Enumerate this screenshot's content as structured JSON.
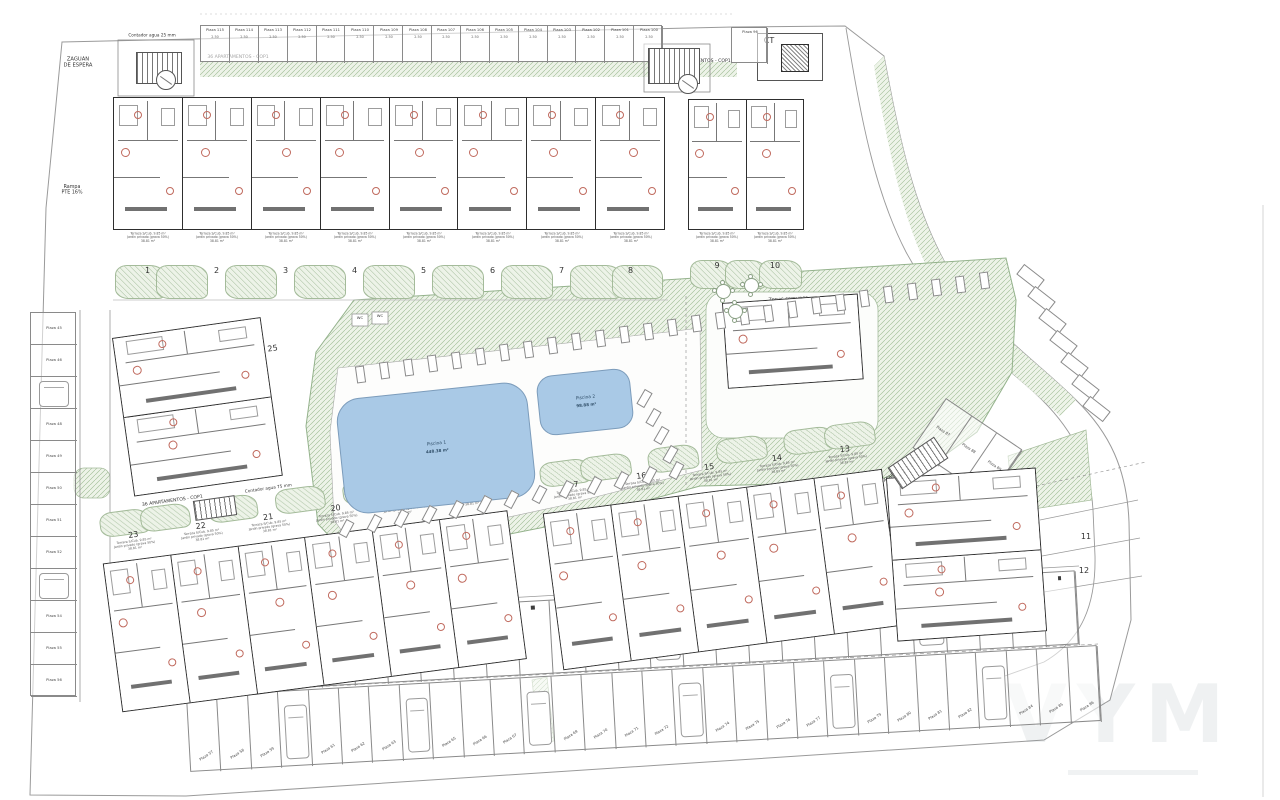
{
  "watermark": {
    "text": "VYM"
  },
  "shared": {
    "unit_caption": [
      "Terraza S/Cub. 9.85 m²",
      "Jardín privado (grava 50%)",
      "38.81 m²"
    ],
    "stall_dim": "2.50"
  },
  "annotations": [
    {
      "text": "ZAGUÁN\nDE ESPERA",
      "x": 78,
      "y": 56,
      "fs": 5.2
    },
    {
      "text": "Contador agua 25 mm",
      "x": 152,
      "y": 33,
      "fs": 4.2
    },
    {
      "text": "36 APARTAMENTOS - COP1",
      "x": 238,
      "y": 54,
      "fs": 4.6
    },
    {
      "text": "36 APARTAMENTOS - COP1",
      "x": 700,
      "y": 58,
      "fs": 4.6
    },
    {
      "text": "20.79 m²",
      "x": 808,
      "y": 34,
      "fs": 3.8
    },
    {
      "text": "Rampa\nPTE 16%",
      "x": 72,
      "y": 184,
      "fs": 4.8
    },
    {
      "text": "36 APARTAMENTOS - COP1",
      "x": 172,
      "y": 498,
      "fs": 4.6,
      "rot": -8
    },
    {
      "text": "Contador agua 75 mm",
      "x": 268,
      "y": 486,
      "fs": 4.2,
      "rot": -8
    },
    {
      "text": "Zonas comunes",
      "x": 788,
      "y": 296,
      "fs": 5,
      "rot": -3
    },
    {
      "text": "40 APARTAMENTOS - COP2",
      "x": 902,
      "y": 466,
      "fs": 4.6,
      "rot": -33
    },
    {
      "text": "WC",
      "x": 360,
      "y": 316,
      "fs": 3.8
    },
    {
      "text": "WC",
      "x": 380,
      "y": 314,
      "fs": 3.8
    },
    {
      "text": "25",
      "x": 272,
      "y": 344,
      "fs": 8,
      "rot": -8
    },
    {
      "text": "24",
      "x": 264,
      "y": 452,
      "fs": 8,
      "rot": -8
    },
    {
      "text": "11",
      "x": 1086,
      "y": 532,
      "fs": 8
    },
    {
      "text": "12",
      "x": 1084,
      "y": 566,
      "fs": 8
    }
  ],
  "ct": {
    "label": "CT",
    "x": 757,
    "y": 33,
    "w": 64,
    "h": 46,
    "inner": {
      "x": 781,
      "y": 44,
      "w": 26,
      "h": 26
    }
  },
  "parking": [
    {
      "name": "top-row",
      "x": 200,
      "y": 25,
      "w": 462,
      "h": 37,
      "count": 16,
      "label_pos": "top",
      "dim": true,
      "labels": [
        "Plaza 115",
        "Plaza 114",
        "Plaza 113",
        "Plaza 112",
        "Plaza 111",
        "Plaza 110",
        "Plaza 109",
        "Plaza 108",
        "Plaza 107",
        "Plaza 106",
        "Plaza 105",
        "Plaza 104",
        "Plaza 103",
        "Plaza 102",
        "Plaza 101",
        "Plaza 100"
      ]
    },
    {
      "name": "top-right",
      "x": 731,
      "y": 27,
      "w": 36,
      "h": 36,
      "count": 1,
      "label_pos": "top",
      "labels": [
        "Plaza 96"
      ]
    },
    {
      "name": "left-column",
      "x": 30,
      "y": 312,
      "w": 46,
      "h": 384,
      "count": 12,
      "vertical": true,
      "cars": [
        2,
        8
      ],
      "labels": [
        "Plaza 45",
        "Plaza 46",
        "Plaza 47",
        "Plaza 48",
        "Plaza 49",
        "Plaza 50",
        "Plaza 51",
        "Plaza 52",
        "Plaza 53",
        "Plaza 54",
        "Plaza 55",
        "Plaza 56"
      ]
    },
    {
      "name": "bottom-upper-row",
      "x": 186,
      "y": 620,
      "w": 890,
      "h": 74,
      "count": 27,
      "rot": -3.2,
      "marks": true,
      "cars": [
        5,
        14,
        22
      ],
      "labels": []
    },
    {
      "name": "bottom-lower-row",
      "x": 186,
      "y": 696,
      "w": 912,
      "h": 76,
      "count": 30,
      "rot": -3.2,
      "label_pos": "bottom",
      "label_rot": -30,
      "cars": [
        3,
        7,
        11,
        16,
        21,
        26
      ],
      "labels": [
        "Plaza 57",
        "Plaza 58",
        "Plaza 59",
        "Plaza 60",
        "Plaza 61",
        "Plaza 62",
        "Plaza 63",
        "Plaza 64",
        "Plaza 65",
        "Plaza 66",
        "Plaza 67",
        "Plaza 68",
        "Plaza 69",
        "Plaza 70",
        "Plaza 71",
        "Plaza 72",
        "Plaza 73",
        "Plaza 74",
        "Plaza 75",
        "Plaza 76",
        "Plaza 77",
        "Plaza 78",
        "Plaza 79",
        "Plaza 80",
        "Plaza 81",
        "Plaza 82",
        "Plaza 83",
        "Plaza 84",
        "Plaza 85",
        "Plaza 86"
      ]
    },
    {
      "name": "road-diagonal",
      "x": 946,
      "y": 398,
      "w": 92,
      "h": 60,
      "count": 3,
      "rot": 34,
      "label_pos": "mid",
      "labels": [
        "Plaza 87",
        "Plaza 88",
        "Plaza 89"
      ]
    }
  ],
  "blocks": [
    {
      "name": "1-8",
      "x": 113,
      "y": 97,
      "w": 552,
      "bh": 133,
      "gh": 70,
      "garden": "below",
      "caption": true,
      "units": [
        "1",
        "2",
        "3",
        "4",
        "5",
        "6",
        "7",
        "8"
      ]
    },
    {
      "name": "9-10",
      "x": 688,
      "y": 99,
      "w": 116,
      "bh": 131,
      "gh": 60,
      "garden": "below",
      "caption": true,
      "units": [
        "9",
        "10"
      ]
    },
    {
      "name": "18-23",
      "x": 96,
      "y": 512,
      "w": 408,
      "bh": 150,
      "gh": 52,
      "garden": "above",
      "caption": true,
      "rot": -7.5,
      "units": [
        "23",
        "22",
        "21",
        "20",
        "19",
        "18"
      ]
    },
    {
      "name": "13-17",
      "x": 536,
      "y": 462,
      "w": 342,
      "bh": 158,
      "gh": 52,
      "garden": "above",
      "caption": true,
      "rot": -7.5,
      "units": [
        "17",
        "16",
        "15",
        "14",
        "13"
      ]
    },
    {
      "name": "11-12",
      "x": 886,
      "y": 478,
      "w": 150,
      "bh": 164,
      "gh": 0,
      "rot": -4,
      "dir": "col",
      "units": [
        "",
        ""
      ]
    },
    {
      "name": "24-25",
      "x": 112,
      "y": 338,
      "w": 150,
      "bh": 160,
      "gh": 0,
      "rot": -8,
      "dir": "col",
      "units": [
        "",
        ""
      ]
    },
    {
      "name": "clubhouse",
      "x": 722,
      "y": 303,
      "w": 136,
      "bh": 86,
      "gh": 0,
      "rot": -4,
      "units": [
        ""
      ]
    }
  ],
  "pools": [
    {
      "name": "pool-1",
      "x": 340,
      "y": 390,
      "w": 192,
      "h": 116,
      "rot": -6,
      "rx": 24,
      "label": "Piscina 1",
      "area": "448.38 m²"
    },
    {
      "name": "pool-2",
      "x": 538,
      "y": 372,
      "w": 94,
      "h": 60,
      "rot": -6,
      "rx": 16,
      "label": "Piscina 2",
      "area": "98.88 m²"
    }
  ],
  "loungers": [
    {
      "name": "loungers-top",
      "x1": 356,
      "y1": 366,
      "x2": 980,
      "y2": 272,
      "count": 27,
      "w": 9,
      "h": 17,
      "rot": -8
    },
    {
      "name": "loungers-bottom",
      "x1": 342,
      "y1": 520,
      "x2": 672,
      "y2": 462,
      "count": 13,
      "w": 9,
      "h": 17,
      "rot": 28
    },
    {
      "name": "loungers-side",
      "x1": 640,
      "y1": 390,
      "x2": 666,
      "y2": 446,
      "count": 4,
      "w": 9,
      "h": 17,
      "rot": 30
    },
    {
      "name": "road-stalls",
      "x1": 1024,
      "y1": 264,
      "x2": 1090,
      "y2": 396,
      "count": 7,
      "w": 13,
      "h": 26,
      "rot": -52
    }
  ],
  "tables": [
    {
      "x": 716,
      "y": 284
    },
    {
      "x": 744,
      "y": 278
    },
    {
      "x": 728,
      "y": 304
    }
  ],
  "stairs": [
    {
      "x": 136,
      "y": 52,
      "w": 46,
      "h": 32
    },
    {
      "x": 648,
      "y": 48,
      "w": 52,
      "h": 36
    },
    {
      "x": 890,
      "y": 450,
      "w": 56,
      "h": 26,
      "rot": -34
    },
    {
      "x": 194,
      "y": 498,
      "w": 42,
      "h": 20,
      "rot": -8
    }
  ],
  "elevators": [
    {
      "x": 156,
      "y": 70,
      "r": 9
    },
    {
      "x": 678,
      "y": 74,
      "r": 9
    }
  ]
}
